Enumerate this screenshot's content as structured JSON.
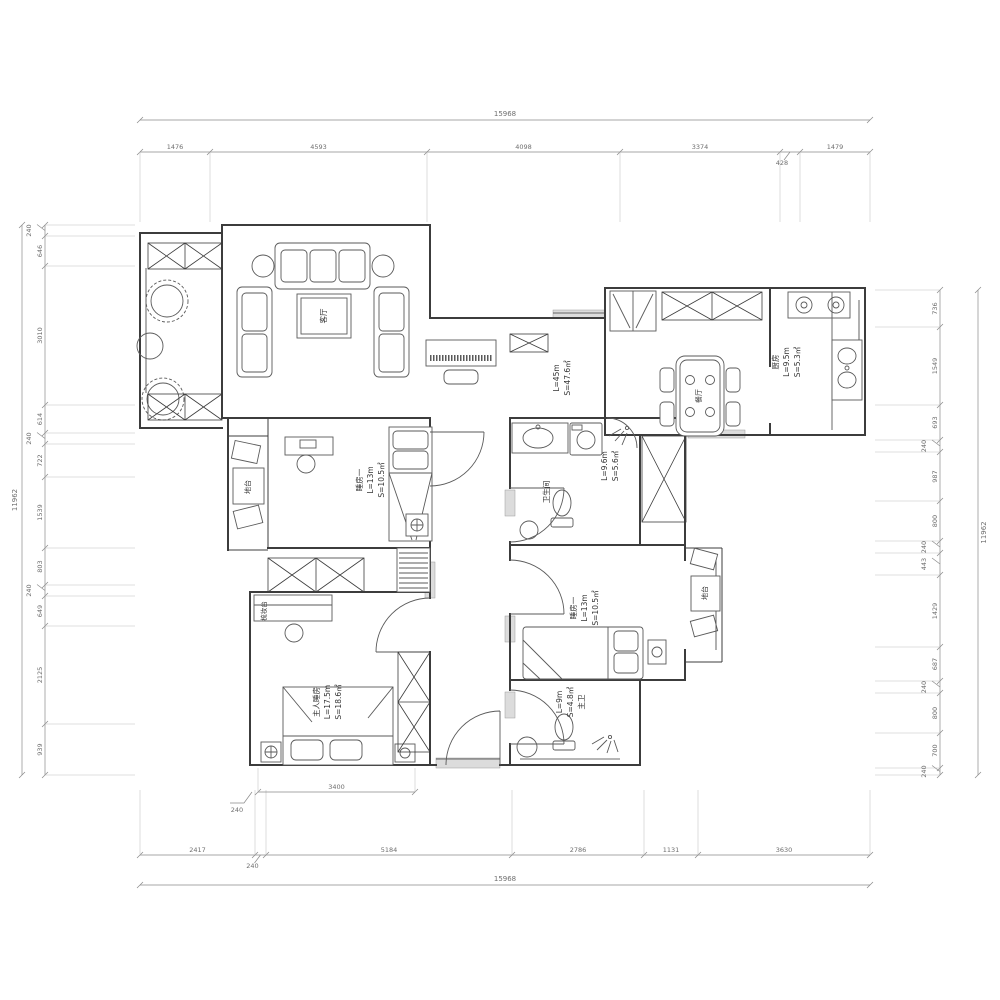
{
  "dimensions": {
    "overall_top": "15968",
    "overall_bottom": "15968",
    "overall_left": "11962",
    "overall_right": "11962",
    "top_segments": [
      "1476",
      "4593",
      "4098",
      "3374",
      "428",
      "1479"
    ],
    "bottom_segments": [
      "2417",
      "240",
      "5184",
      "2786",
      "1131",
      "3630"
    ],
    "left_segments": [
      "240",
      "646",
      "3010",
      "614",
      "240",
      "722",
      "1539",
      "803",
      "240",
      "649",
      "2125",
      "939"
    ],
    "right_segments": [
      "736",
      "1549",
      "693",
      "240",
      "987",
      "800",
      "240",
      "443",
      "1429",
      "687",
      "240",
      "800",
      "700",
      "240"
    ],
    "interior_segments": [
      "3400"
    ],
    "interior_leader": "240"
  },
  "rooms": {
    "living": {
      "name": "客厅"
    },
    "living_dining_stats": {
      "lines": [
        "S=47.6㎡",
        "L=45m"
      ]
    },
    "dining": {
      "name": "餐厅"
    },
    "kitchen": {
      "lines": [
        "S=5.3㎡",
        "L=9.5m",
        "厨房"
      ]
    },
    "bedroom1": {
      "lines": [
        "S=10.5㎡",
        "L=13m",
        "睡房一"
      ]
    },
    "bathroom": {
      "name": "卫生间",
      "lines": [
        "S=5.6㎡",
        "L=9.6m"
      ]
    },
    "bedroom2": {
      "lines": [
        "S=10.5㎡",
        "L=13m",
        "睡房一"
      ]
    },
    "master_bedroom": {
      "lines": [
        "S=18.6㎡",
        "L=17.5m",
        "主人睡房"
      ]
    },
    "master_bath": {
      "lines": [
        "主卫",
        "S=4.8㎡",
        "L=9m"
      ]
    },
    "platform_left": {
      "name": "地台"
    },
    "platform_right": {
      "name": "地台"
    },
    "dresser": {
      "name": "梳妆台"
    }
  },
  "colors": {
    "wall": "#3c3c3c",
    "furniture": "#5a5a5a",
    "dimension": "#6e6e6e",
    "background": "#ffffff"
  }
}
